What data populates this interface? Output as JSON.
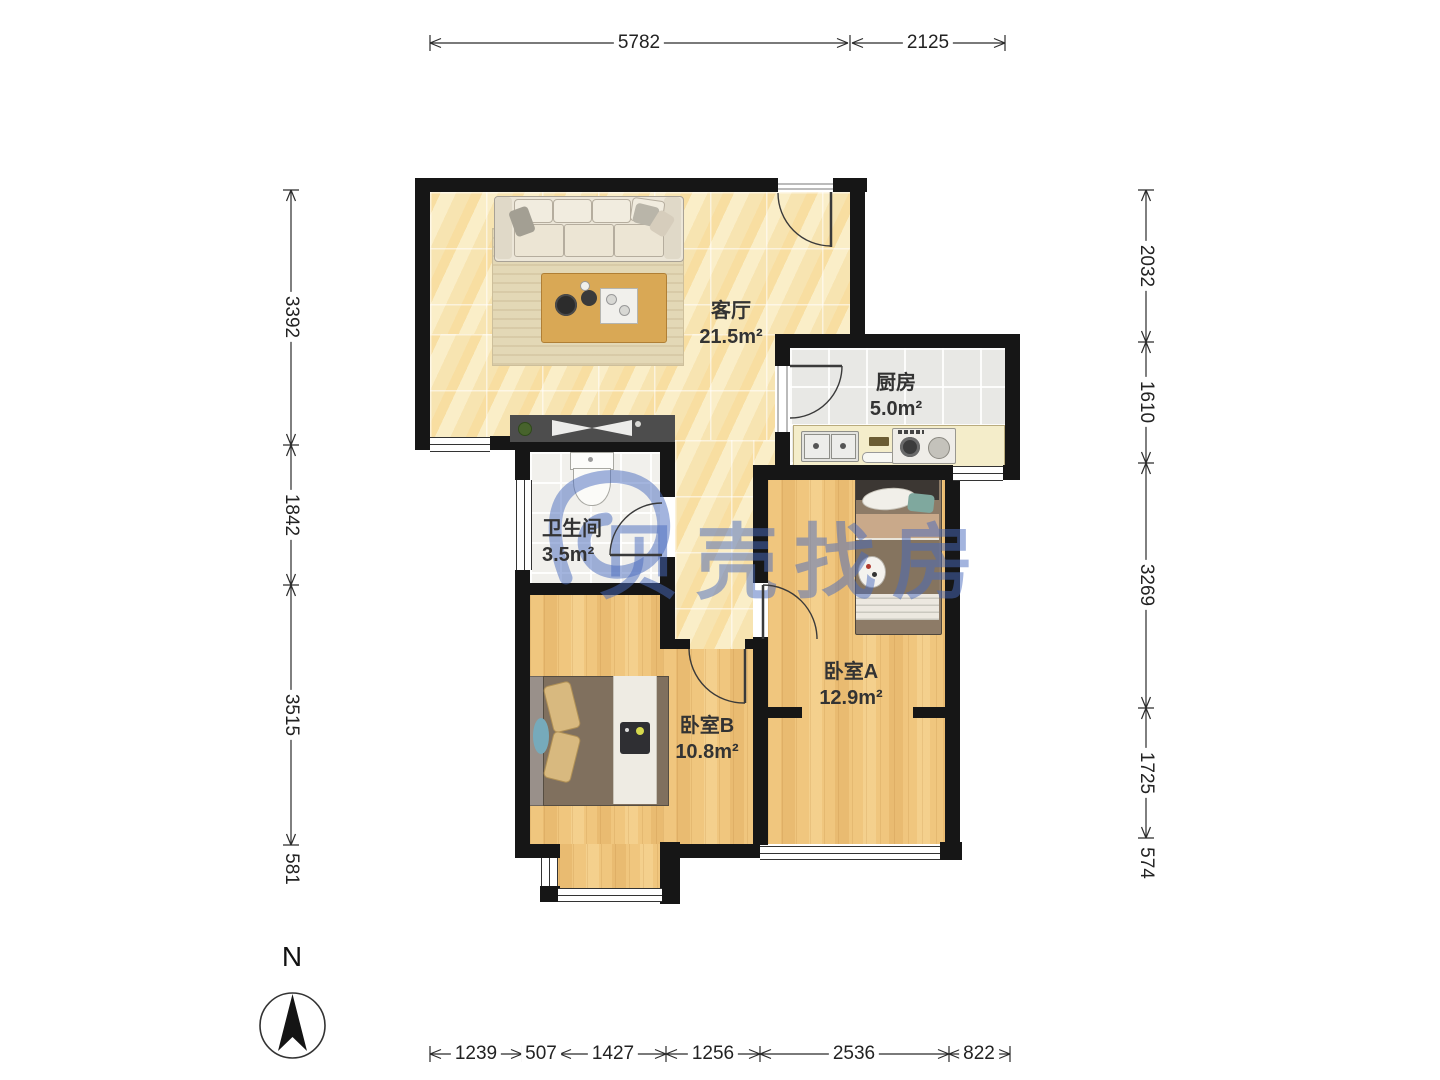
{
  "watermark": {
    "text": "贝壳找房"
  },
  "compass": {
    "north": "N"
  },
  "rooms": [
    {
      "name": "客厅",
      "area": "21.5m²"
    },
    {
      "name": "厨房",
      "area": "5.0m²"
    },
    {
      "name": "卫生间",
      "area": "3.5m²"
    },
    {
      "name": "卧室A",
      "area": "12.9m²"
    },
    {
      "name": "卧室B",
      "area": "10.8m²"
    }
  ],
  "dimensions": {
    "top": [
      "5782",
      "2125"
    ],
    "left": [
      "3392",
      "1842",
      "3515",
      "581"
    ],
    "right": [
      "2032",
      "1610",
      "3269",
      "1725",
      "574"
    ],
    "bottom": [
      "1239",
      "507",
      "1427",
      "1256",
      "2536",
      "822"
    ]
  },
  "colors": {
    "wall": "#161616",
    "watermark_blue": "#4a6cbc",
    "marble_floor": "#f9ecc3",
    "wood_floor": "#f0c67e",
    "dim_text": "#222222"
  }
}
